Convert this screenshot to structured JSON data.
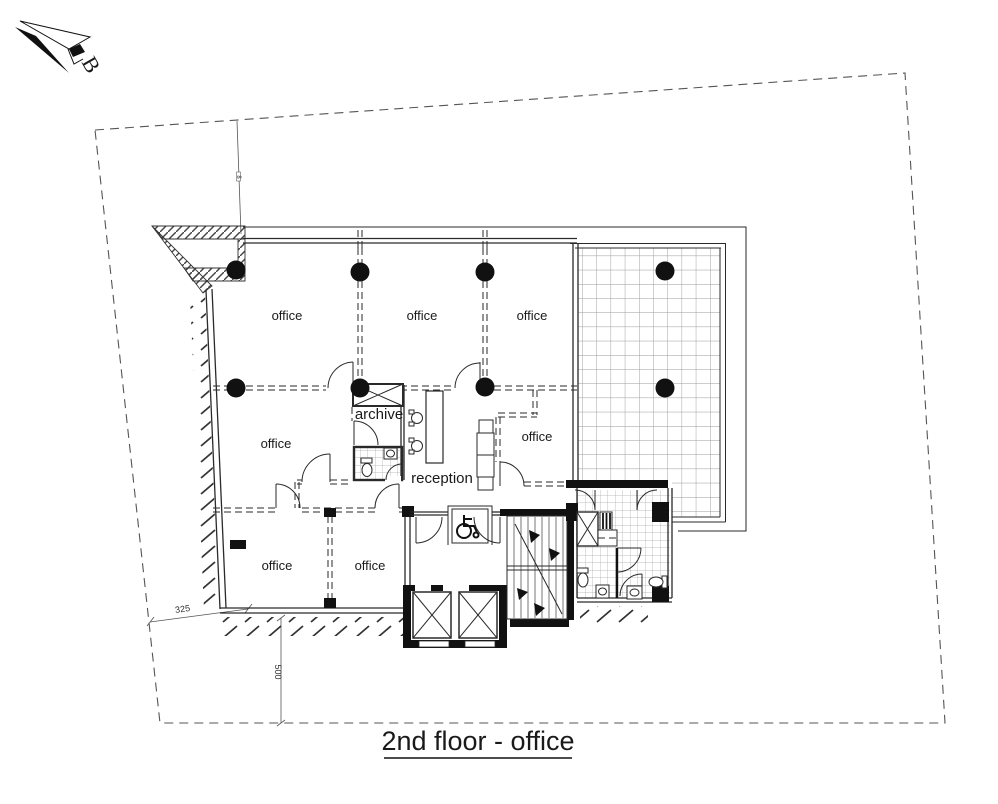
{
  "drawing": {
    "title": "2nd floor - office",
    "north_label": "B"
  },
  "labels": {
    "office_top_left": "office",
    "office_top_mid": "office",
    "office_top_right": "office",
    "office_mid_left": "office",
    "office_mid_right": "office",
    "office_bottom_left": "office",
    "office_bottom_mid": "office",
    "archive": "archive",
    "reception": "reception"
  },
  "dimensions": {
    "boundary_offset_left": "325",
    "boundary_offset_bottom": "500",
    "small_marker": "8"
  },
  "colors": {
    "ink": "#1a1a1a",
    "boundary_line": "#555555",
    "terrace_grid_line": "#999999",
    "tile_line": "#aaaaaa",
    "background": "#ffffff"
  }
}
